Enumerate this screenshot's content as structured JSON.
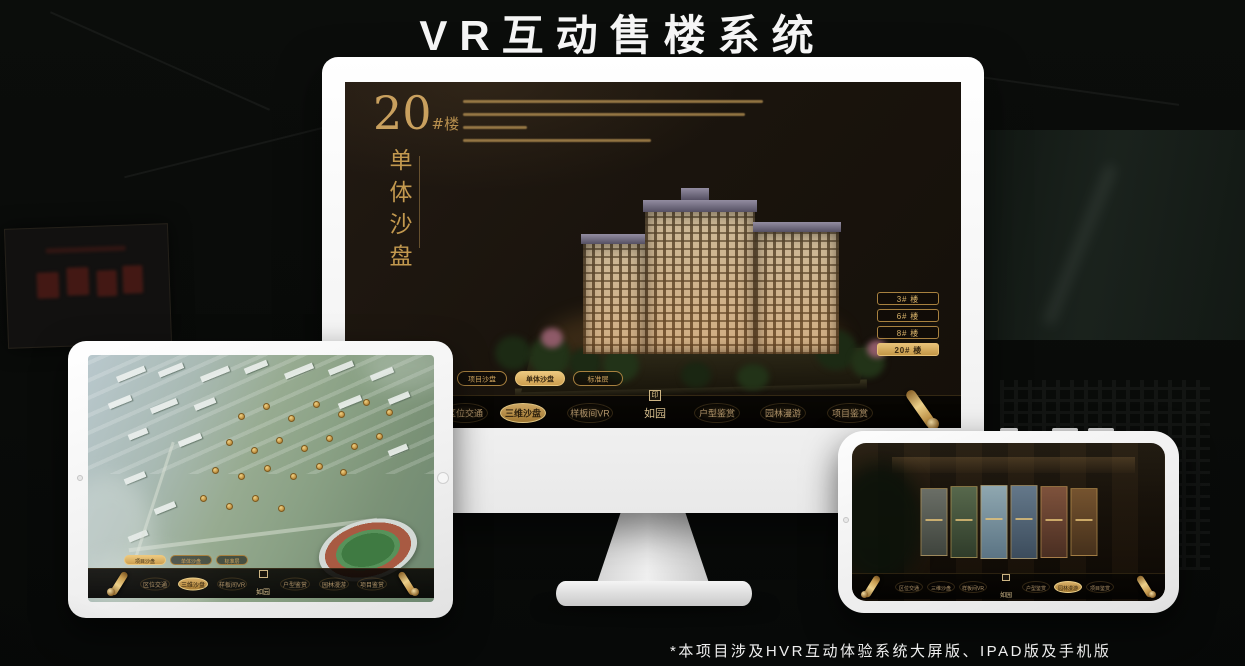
{
  "title": "VR互动售楼系统",
  "footnote": "*本项目涉及HVR互动体验系统大屏版、IPAD版及手机版",
  "colors": {
    "gold": "#c9a05e",
    "gold_bright": "#e8c87e",
    "gold_button_text": "#3a2a12",
    "screen_bg": "#1b140d",
    "page_bg": "#0a0c0a",
    "title_white": "#f5f5f5"
  },
  "menu": {
    "logo": "如园",
    "seal_glyph": "印",
    "items": [
      {
        "label": "区位交通"
      },
      {
        "label": "三维沙盘"
      },
      {
        "label": "样板间VR"
      },
      {
        "label": "户型鉴赏"
      },
      {
        "label": "园林漫游"
      },
      {
        "label": "项目鉴赏"
      }
    ]
  },
  "sub_tabs": [
    {
      "label": "项目沙盘"
    },
    {
      "label": "单体沙盘"
    },
    {
      "label": "标准层"
    }
  ],
  "monitor": {
    "headline_number": "20",
    "headline_unit": "#楼",
    "headline_subtitle": "单体沙盘",
    "active_sub_tab": "单体沙盘",
    "active_menu_item": "三维沙盘",
    "floor_buttons": [
      {
        "label": "3# 楼",
        "active": false
      },
      {
        "label": "6# 楼",
        "active": false
      },
      {
        "label": "8# 楼",
        "active": false
      },
      {
        "label": "20# 楼",
        "active": true
      }
    ]
  },
  "tablet": {
    "active_sub_tab": "项目沙盘",
    "active_menu_item": "三维沙盘"
  },
  "phone": {
    "active_menu_item": "园林漫游"
  }
}
